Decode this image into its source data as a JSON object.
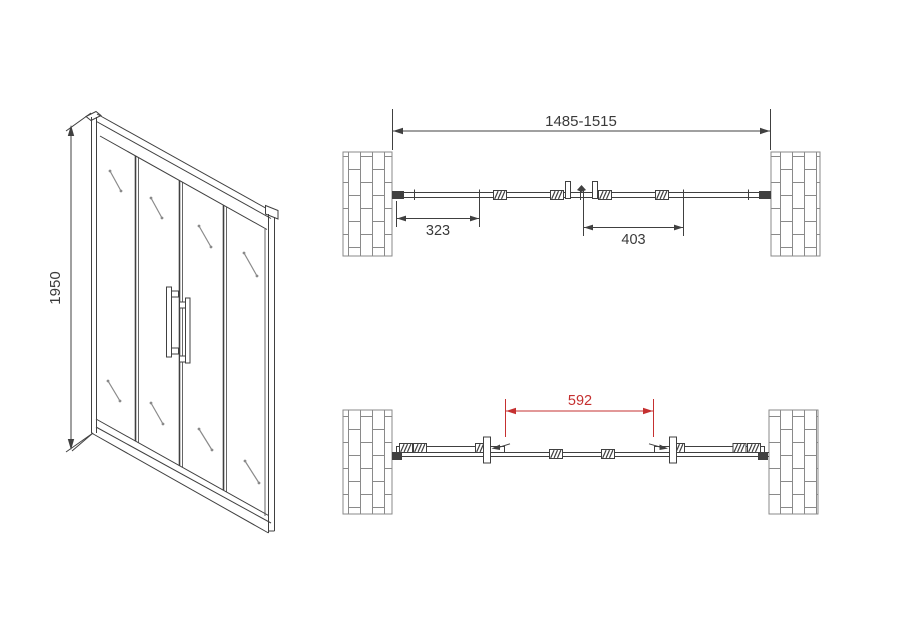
{
  "meta": {
    "title": "Sliding shower door dimensional drawing"
  },
  "colors": {
    "line": "#404040",
    "brick_line": "#8a8a8a",
    "glass_mark": "#8a8a8a",
    "dimension_text": "#3a3a3a",
    "accent_red": "#c53030",
    "background": "#ffffff"
  },
  "front_view": {
    "height_dim": "1950"
  },
  "plan_view_closed": {
    "overall_width_dim": "1485-1515",
    "left_door_dim": "323",
    "right_door_dim": "403"
  },
  "plan_view_open": {
    "opening_dim": "592"
  }
}
